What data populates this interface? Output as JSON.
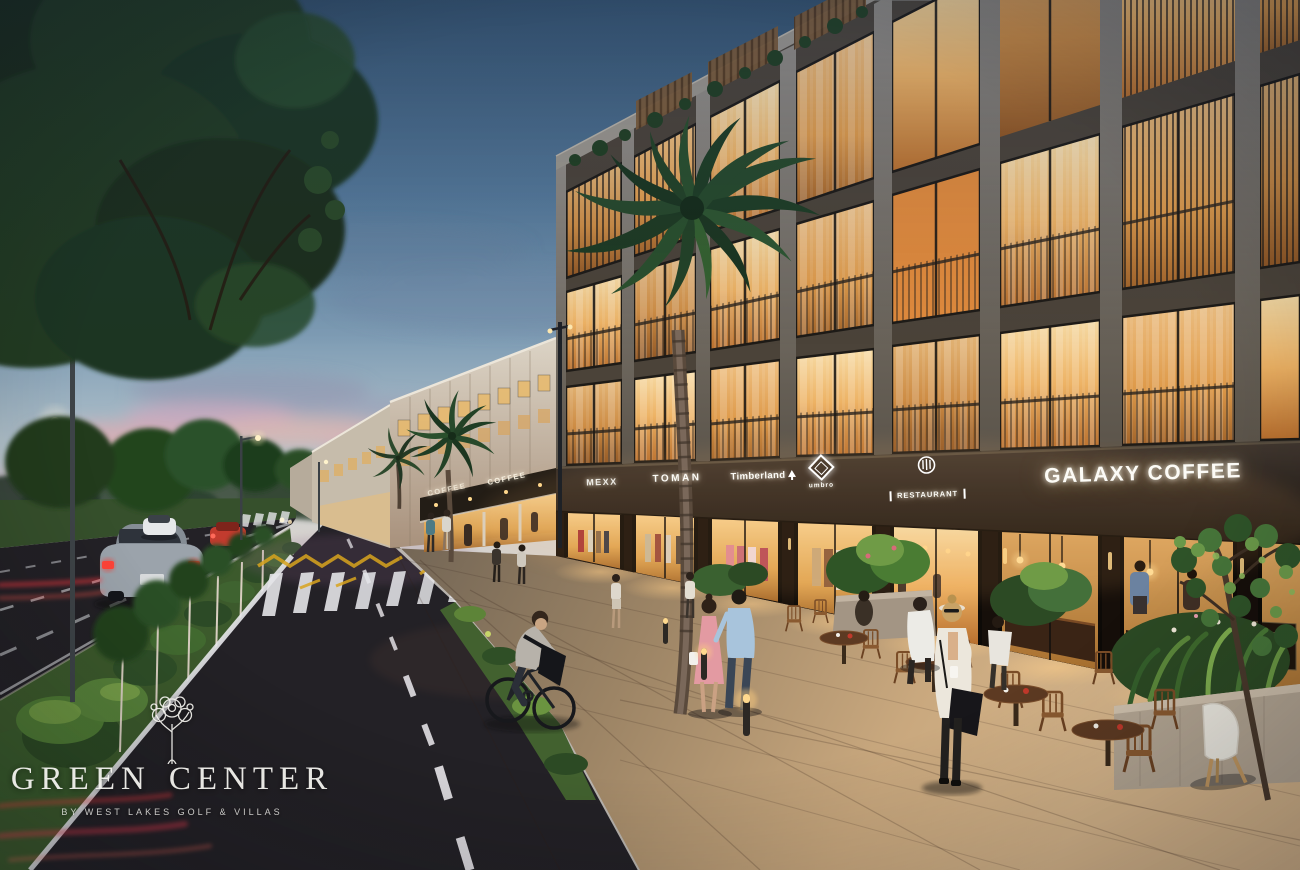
{
  "scene": {
    "colors": {
      "sky_top": "#35526d",
      "sky_horizon": "#d6d3cf",
      "sunset_pink": "#e0a8ae",
      "building_concrete": "#84807b",
      "sign_band": "#362e27",
      "window_glow": "#f3c07a",
      "asphalt": "#2c2a2e",
      "grass": "#5d7c3b",
      "pavement_warm": "#c5a279"
    }
  },
  "storefront_signs": [
    {
      "label": "MEXX"
    },
    {
      "label": "TOMAN"
    },
    {
      "label": "Timberland"
    },
    {
      "label": "umbro"
    },
    {
      "label": "RESTAURANT"
    },
    {
      "label": "GALAXY COFFEE"
    }
  ],
  "distant_signs": {
    "coffee_1": "COFFEE",
    "coffee_2": "COFFEE"
  },
  "logo": {
    "name_left": "GREEN",
    "name_right": "CENTER",
    "tagline": "BY WEST LAKES GOLF & VILLAS"
  }
}
